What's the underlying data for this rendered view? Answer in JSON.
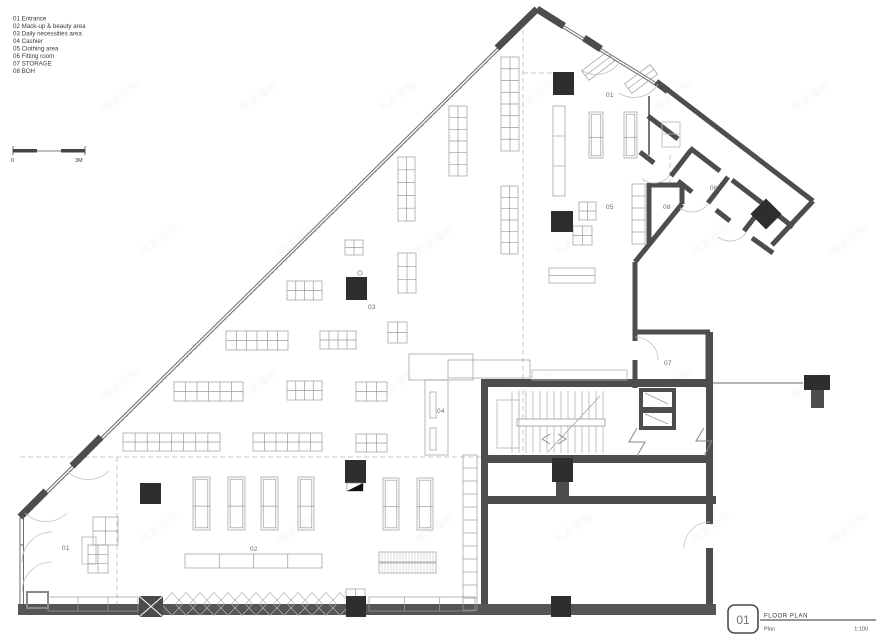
{
  "legend": {
    "items": [
      "01 Entrance",
      "02 Mack-up & beauty area",
      "03 Daily necessities area",
      "04 Cashier",
      "05 Clothing area",
      "06 Fitting room",
      "07 STORAGE",
      "08 BOH"
    ]
  },
  "scale_bar": {
    "start_label": "0",
    "end_label": "3M"
  },
  "plan_labels": [
    "01",
    "05",
    "08",
    "06",
    "03",
    "07",
    "04",
    "01",
    "02"
  ],
  "title_block": {
    "number": "01",
    "title": "FLOOR PLAN",
    "subtitle": "Plan",
    "scale": "1:100"
  },
  "watermark": {
    "text": "知末案例"
  },
  "colors": {
    "wall": "#4d4d4d",
    "column": "#2e2e2e",
    "fixture": "#9a9a9a"
  }
}
